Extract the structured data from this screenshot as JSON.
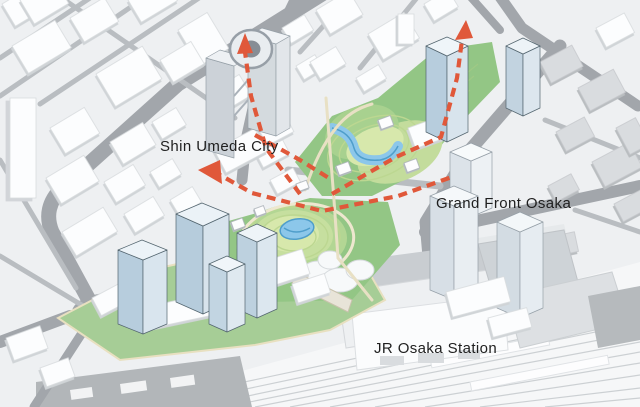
{
  "scene": {
    "type": "aerial-axonometric-masterplan",
    "labels": {
      "shin_umeda_city": "Shin Umeda City",
      "grand_front_osaka": "Grand Front Osaka",
      "jr_osaka_station": "JR Osaka Station"
    },
    "colors": {
      "arrow_orange": "#e0583a",
      "park_green": "#93c685",
      "lawn_green": "#a6cd96",
      "contour_yellow_green": "#d7e8ac",
      "pond_blue": "#8cc7ea",
      "pond_outline_blue": "#4f9ecb",
      "road_gray": "#a2a6ab",
      "landmark_blue": "#b7cddd",
      "context_white": "#fcfdfe",
      "label_text": "#1f1f1f"
    }
  }
}
